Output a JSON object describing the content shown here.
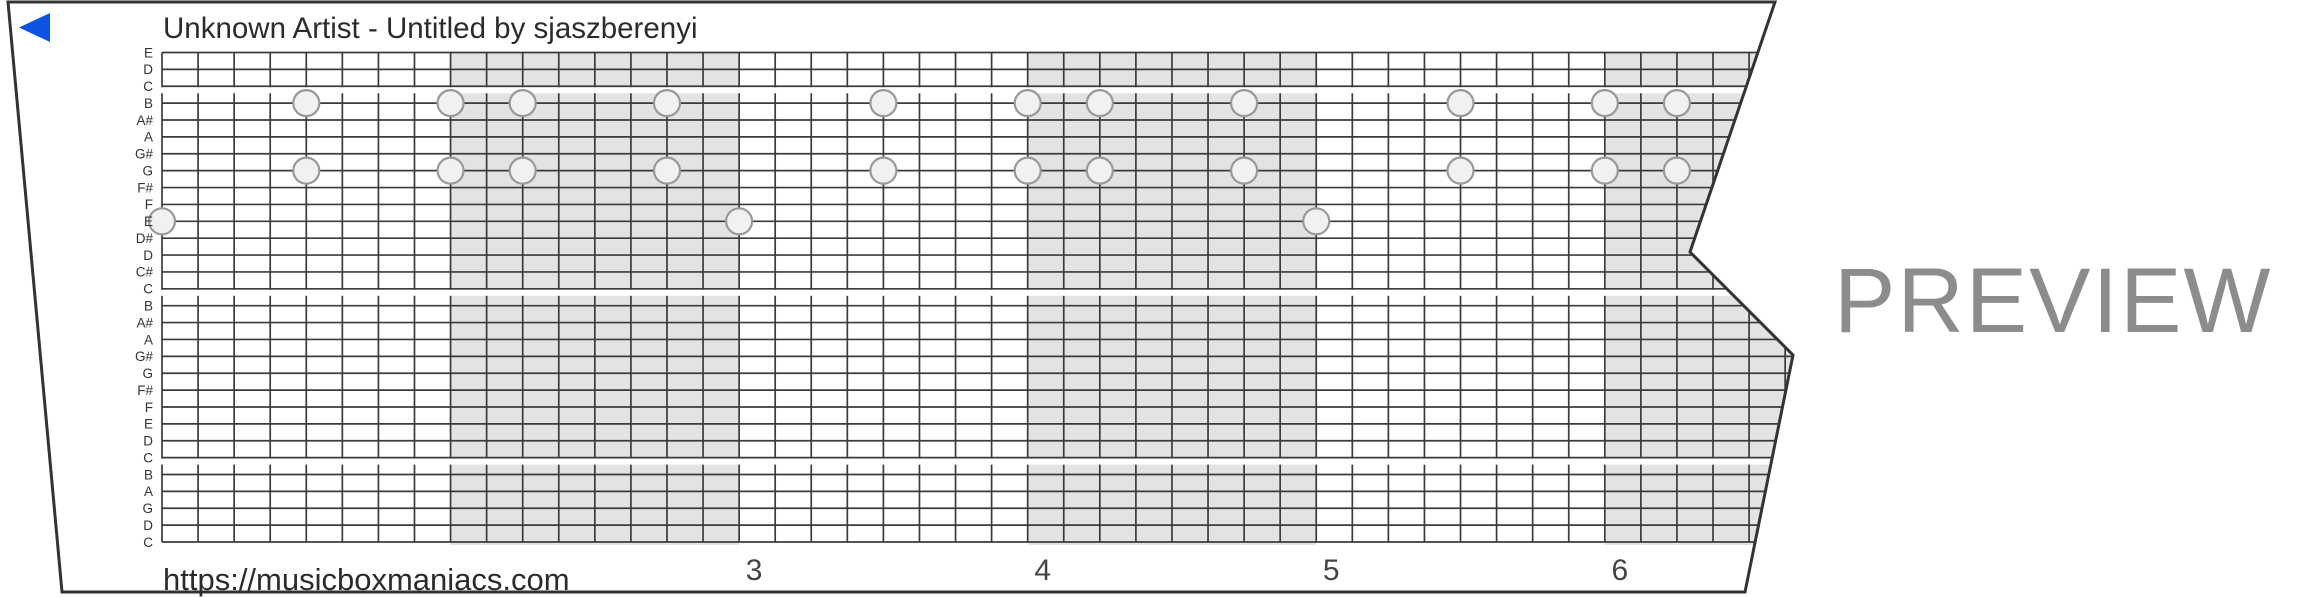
{
  "header": {
    "title": "Unknown Artist - Untitled by sjaszberenyi"
  },
  "footer": {
    "url": "https://musicboxmaniacs.com"
  },
  "watermark": "PREVIEW",
  "player": {
    "rewind_color": "#0b53e0"
  },
  "strip": {
    "note_labels": [
      "E",
      "D",
      "C",
      "B",
      "A#",
      "A",
      "G#",
      "G",
      "F#",
      "F",
      "E",
      "D#",
      "D",
      "C#",
      "C",
      "B",
      "A#",
      "A",
      "G#",
      "G",
      "F#",
      "F",
      "E",
      "D",
      "C",
      "B",
      "A",
      "G",
      "D",
      "C"
    ],
    "octave_break_rows": [
      2,
      14,
      24
    ],
    "measure_numbers": [
      "3",
      "4",
      "5",
      "6"
    ],
    "first_numbered_measure": 3,
    "beats_per_measure": 8,
    "shaded_measures": [
      2,
      4,
      6
    ],
    "notes": [
      {
        "pitch": "B",
        "row": 3,
        "beats": [
          4,
          8,
          10,
          14,
          20,
          24,
          26,
          30,
          36,
          40,
          42
        ]
      },
      {
        "pitch": "G",
        "row": 7,
        "beats": [
          4,
          8,
          10,
          14,
          20,
          24,
          26,
          30,
          36,
          40,
          42
        ]
      },
      {
        "pitch": "E",
        "row": 10,
        "beats": [
          0,
          16,
          32
        ]
      }
    ],
    "colors": {
      "paper": "#ffffff",
      "outline": "#333333",
      "grid": "#3b3b3b",
      "shade": "#e3e3e3",
      "hole_fill": "#f1f1f1",
      "hole_stroke": "#999999",
      "label": "#333333",
      "number": "#444444"
    }
  }
}
